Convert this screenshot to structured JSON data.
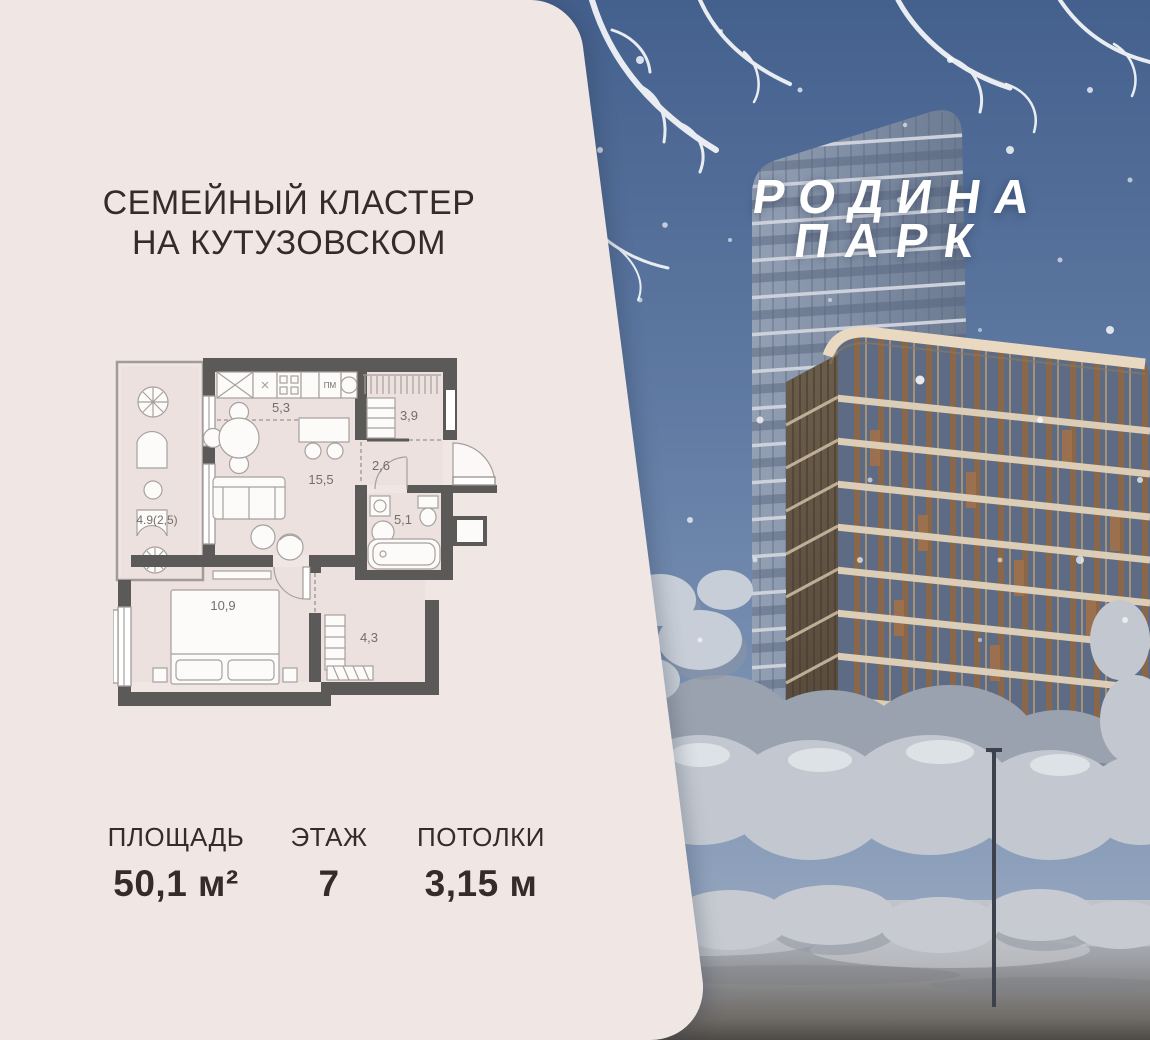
{
  "banner": {
    "project": {
      "cluster_title_line1": "СЕМЕЙНЫЙ КЛАСТЕР",
      "cluster_title_line2": "НА КУТУЗОВСКОМ",
      "logo_line1": "РОДИНА",
      "logo_line2": "ПАРК"
    },
    "apartment": {
      "stats": [
        {
          "label": "ПЛОЩАДЬ",
          "value": "50,1 м²"
        },
        {
          "label": "ЭТАЖ",
          "value": "7"
        },
        {
          "label": "ПОТОЛКИ",
          "value": "3,15 м"
        }
      ],
      "floorplan": {
        "room_areas": {
          "kitchen": "5,3",
          "closet": "3,9",
          "hallway": "2,6",
          "living_room": "15,5",
          "bathroom": "5,1",
          "bedroom": "10,9",
          "wardrobe": "4,3",
          "balcony": "4.9(2,5)"
        },
        "appliance_labels": {
          "dishwasher": "ПМ"
        }
      }
    },
    "colors": {
      "card_bg": "#f0e7e5",
      "title_text": "#352b28",
      "plan_walls": "#5b5a58",
      "sky_top": "#44608d",
      "logo_text": "#ffffff"
    }
  }
}
